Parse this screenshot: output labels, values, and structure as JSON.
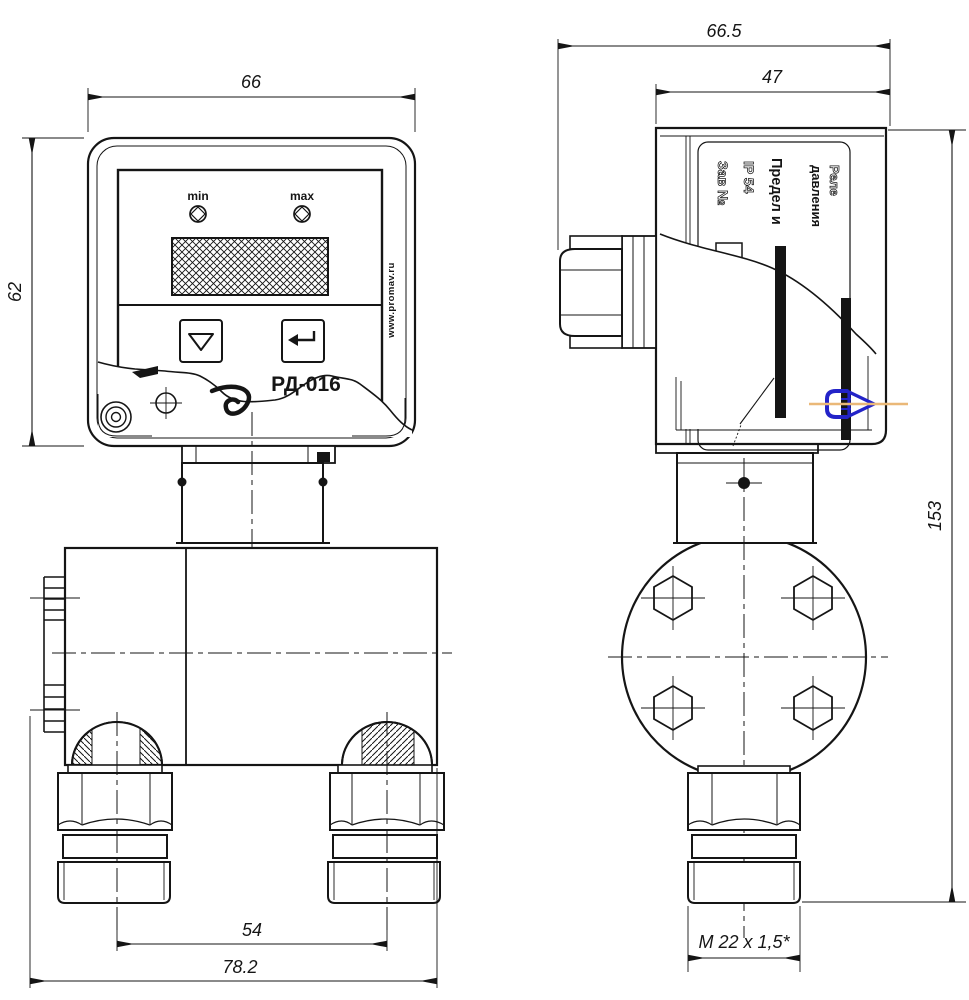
{
  "front_view": {
    "dims": {
      "width": "66",
      "height": "62",
      "port_spacing": "54",
      "overall_width": "78.2"
    },
    "panel": {
      "min": "min",
      "max": "max",
      "brand": "Реле",
      "model": "РД-016",
      "website": "www.promav.ru"
    }
  },
  "side_view": {
    "dims": {
      "overall_depth": "66.5",
      "body_depth": "47",
      "overall_height": "153",
      "thread": "M 22 x 1,5*"
    },
    "nameplate": {
      "line1": "Реле",
      "line2": "давления",
      "line3": "Предел и",
      "line4": "IP 54",
      "line5": "Зав №"
    }
  },
  "colors": {
    "line": "#151515",
    "blue": "#2323c8",
    "orange": "#eab878",
    "paper": "#ffffff"
  }
}
